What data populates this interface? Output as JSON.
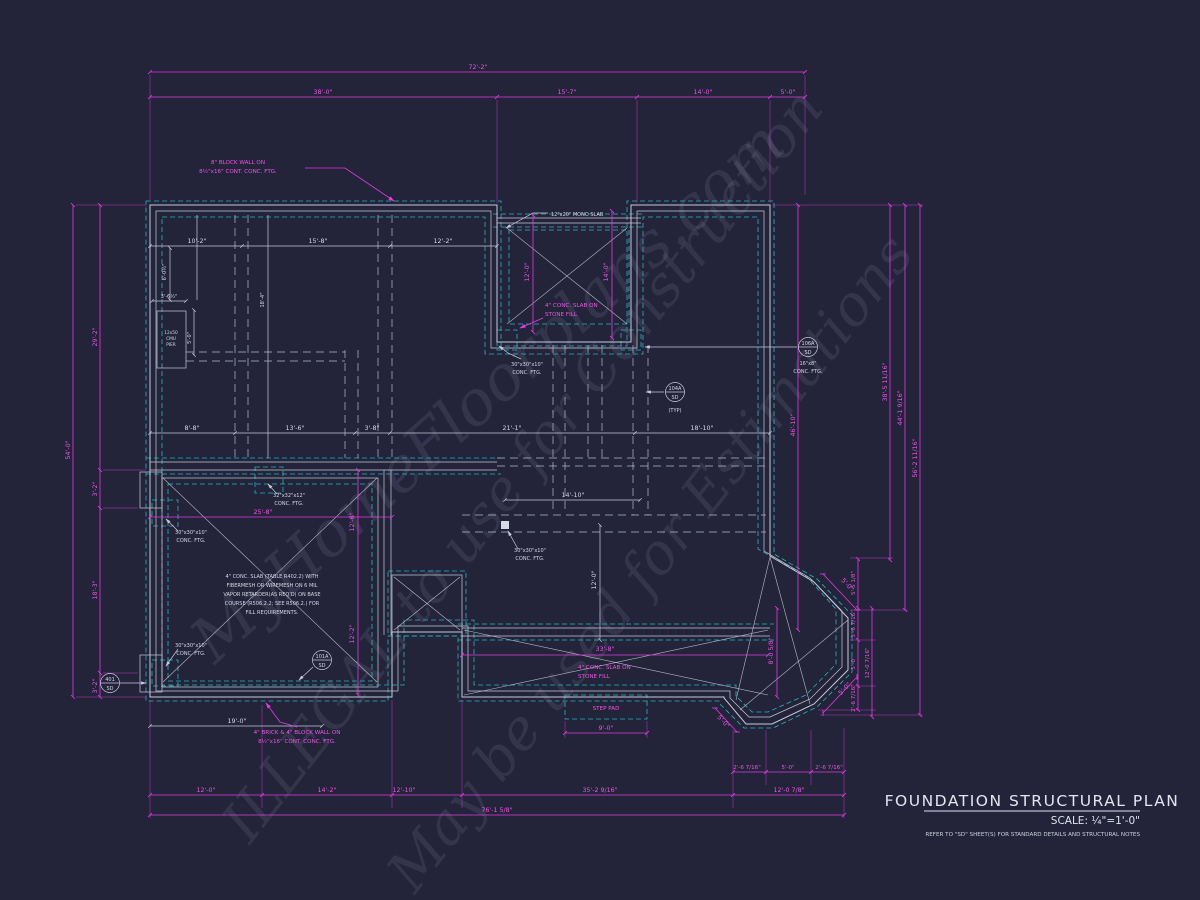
{
  "colors": {
    "background": "#23233a",
    "wall_lines": "#c6cad8",
    "footing_dashed": "#2db4be",
    "dimension_magenta": "#e23ce2",
    "text_white": "#d6dae6"
  },
  "watermarks": {
    "brand": "MyHomeFloorplans.com",
    "warning": "ILLEGAL to use for Construction",
    "estimation": "May be used for Estimations"
  },
  "title_block": {
    "title": "FOUNDATION STRUCTURAL PLAN",
    "scale": "SCALE: ¼\"=1'-0\"",
    "note": "REFER TO \"SD\" SHEET(S) FOR STANDARD DETAILS AND STRUCTURAL NOTES"
  },
  "dims_top": {
    "overall": "72'-2\"",
    "s1": "38'-0\"",
    "s2": "15'-7\"",
    "s3": "14'-0\"",
    "s4": "5'-0\""
  },
  "dims_left": {
    "overall": "54'-0\"",
    "s1": "29'-2\"",
    "s2": "3'-2\"",
    "s3": "18'-3\"",
    "s4": "3'-2\""
  },
  "dims_right": {
    "d1": "38'-5 11/16\"",
    "d2": "44'-1 9/16\"",
    "d3": "56'-2 11/16\"",
    "inner": "46'-10\"",
    "s1": "5'-5 1/8\"",
    "s2": "3'-6 7/16\"",
    "s3": "5'-0\"",
    "s4": "2'-6 7/16\"",
    "s5": "12'-0 7/16\""
  },
  "dims_bottom": {
    "overall": "76'-1 5/8\"",
    "s1": "12'-0\"",
    "s2": "14'-2\"",
    "s3": "12'-10\"",
    "s4": "35'-2 9/16\"",
    "s5": "12'-0 7/8\"",
    "t1": "2'-6 7/16\"",
    "t2": "5'-0\"",
    "t3": "2'-6 7/16\""
  },
  "dims_interior": {
    "a1": "10'-2\"",
    "a2": "15'-8\"",
    "a3": "12'-2\"",
    "a4": "6'-0½\"",
    "a5": "18'-4\"",
    "a6": "3'-6½\"",
    "a7": "5'-0\"",
    "b1": "8'-8\"",
    "b2": "13'-6\"",
    "b3": "3'-8\"",
    "b4": "21'-1\"",
    "b5": "18'-10\"",
    "c1": "14'-10\"",
    "c2": "12'-0\"",
    "porch_w": "12'-0\"",
    "porch_d": "14'-0\"",
    "gar_w": "25'-8\"",
    "gar_d1": "12'-6\"",
    "gar_d2": "12'-2\"",
    "gar_b": "19'-0\"",
    "patio_w": "33'-8\"",
    "step_w": "9'-0\"",
    "bay_h": "8'-0 5/8\"",
    "bay_s": "5'-0\""
  },
  "annotations": {
    "block_wall_1": "8\" BLOCK WALL ON",
    "block_wall_2": "8½\"x16\" CONT. CONC. FTG.",
    "brick_wall_1": "4\" BRICK & 4\" BLOCK WALL ON",
    "brick_wall_2": "8½\"x16\" CONT. CONC. FTG.",
    "mono_slab": "12\"x20\" MONO SLAB",
    "slab_fill_1": "4\" CONC. SLAB ON",
    "slab_fill_2": "STONE FILL",
    "step_pad": "STEP PAD",
    "ftg30_1": "30\"x30\"x10\"",
    "ftg30_2": "CONC. FTG.",
    "ftg32_1": "32\"x32\"x12\"",
    "ftg32_2": "CONC. FTG.",
    "ftg16_1": "16\"x8\"",
    "ftg16_2": "CONC. FTG.",
    "typ": "(TYP)",
    "spec_1": "4\" CONC. SLAB (TABLE R402.2) WITH",
    "spec_2": "FIBERMESH OR WIREMESH ON 6 MIL",
    "spec_3": "VAPOR RETARDER(AS REQ'D) ON BASE",
    "spec_4": "COURSE (R506.2.2; SEE R506.2.) FOR",
    "spec_5": "FILL REQUIREMENTS.",
    "pier_1": "12x50",
    "pier_2": "CMU",
    "pier_3": "PIER"
  },
  "callouts": {
    "c104a_top": "104A",
    "c104a_bot": "SD",
    "c106a_top": "106A",
    "c106a_bot": "SD",
    "c101a_top": "101A",
    "c101a_bot": "SD",
    "c401_top": "401",
    "c401_bot": "SD"
  }
}
